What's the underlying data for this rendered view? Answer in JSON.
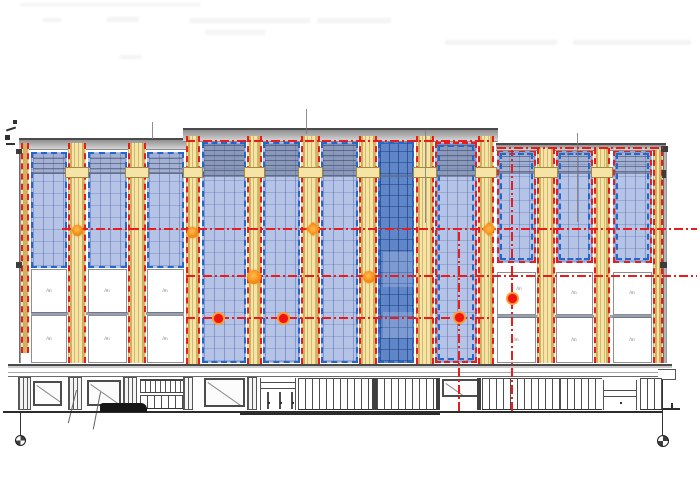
{
  "drawing": {
    "panel_mark": "/m",
    "colors": {
      "yellow": "#f5e4a6",
      "panel-blue": "#b4c3e6",
      "panel-dark": "#5e86c8",
      "red": "#e81c1c",
      "dotred": "#f01410",
      "orange": "#f58c16",
      "blue-dash": "#2268cc"
    },
    "smudges": [
      {
        "x": 20,
        "y": 3,
        "w": 180,
        "h": 3
      },
      {
        "x": 43,
        "y": 18,
        "w": 18,
        "h": 4
      },
      {
        "x": 107,
        "y": 17,
        "w": 32,
        "h": 5
      },
      {
        "x": 190,
        "y": 18,
        "w": 120,
        "h": 5
      },
      {
        "x": 317,
        "y": 18,
        "w": 74,
        "h": 5
      },
      {
        "x": 205,
        "y": 30,
        "w": 60,
        "h": 5
      },
      {
        "x": 445,
        "y": 40,
        "w": 112,
        "h": 5
      },
      {
        "x": 573,
        "y": 40,
        "w": 118,
        "h": 5
      },
      {
        "x": 120,
        "y": 55,
        "w": 22,
        "h": 4
      }
    ],
    "roof_bands": [
      {
        "x": 19,
        "y": 138,
        "w": 167,
        "h": 12
      },
      {
        "x": 183,
        "y": 128,
        "w": 315,
        "h": 14
      },
      {
        "x": 496,
        "y": 143,
        "w": 170,
        "h": 8
      }
    ],
    "leader_lines": [
      {
        "x": 152,
        "y": 122,
        "h": 17
      },
      {
        "x": 306,
        "y": 109,
        "h": 25
      },
      {
        "x": 425,
        "y": 130,
        "h": 93
      },
      {
        "x": 577,
        "y": 133,
        "h": 89
      }
    ],
    "edge_bands": [
      {
        "x": 19,
        "y": 150,
        "w": 2,
        "h": 213
      },
      {
        "x": 663,
        "y": 151,
        "w": 4,
        "h": 212
      }
    ],
    "edge_squares": [
      {
        "x": 16,
        "y": 149,
        "w": 6,
        "h": 5
      },
      {
        "x": 16,
        "y": 262,
        "w": 6,
        "h": 6
      },
      {
        "x": 661,
        "y": 146,
        "w": 7,
        "h": 6
      },
      {
        "x": 662,
        "y": 170,
        "w": 4,
        "h": 8
      },
      {
        "x": 660,
        "y": 262,
        "w": 7,
        "h": 6
      }
    ],
    "tiny_marks": [
      {
        "x": 13,
        "y": 120,
        "w": 4,
        "h": 4,
        "r": 0
      },
      {
        "x": 6,
        "y": 128,
        "w": 10,
        "h": 2,
        "r": -18
      },
      {
        "x": 5,
        "y": 135,
        "w": 5,
        "h": 5,
        "r": 0
      },
      {
        "x": 6,
        "y": 143,
        "w": 9,
        "h": 2,
        "r": 0
      }
    ],
    "yellow_strips": [
      {
        "x": 21,
        "y": 143,
        "w": 8,
        "h": 210,
        "cap": false
      },
      {
        "x": 68,
        "y": 143,
        "w": 18,
        "h": 220,
        "cap": true
      },
      {
        "x": 128,
        "y": 143,
        "w": 18,
        "h": 220,
        "cap": true
      },
      {
        "x": 186,
        "y": 136,
        "w": 14,
        "h": 228,
        "cap": true
      },
      {
        "x": 247,
        "y": 136,
        "w": 15,
        "h": 228,
        "cap": true
      },
      {
        "x": 301,
        "y": 136,
        "w": 19,
        "h": 228,
        "cap": true
      },
      {
        "x": 359,
        "y": 136,
        "w": 18,
        "h": 228,
        "cap": true
      },
      {
        "x": 416,
        "y": 136,
        "w": 18,
        "h": 228,
        "cap": true
      },
      {
        "x": 478,
        "y": 136,
        "w": 16,
        "h": 228,
        "cap": true
      },
      {
        "x": 537,
        "y": 148,
        "w": 18,
        "h": 215,
        "cap": true
      },
      {
        "x": 594,
        "y": 148,
        "w": 16,
        "h": 215,
        "cap": true
      },
      {
        "x": 653,
        "y": 150,
        "w": 10,
        "h": 213,
        "cap": false
      }
    ],
    "blue_panels": [
      {
        "x": 31,
        "y": 152,
        "w": 36,
        "h": 116,
        "band": "soft",
        "bh": 20
      },
      {
        "x": 88,
        "y": 152,
        "w": 39,
        "h": 116,
        "band": "soft",
        "bh": 20
      },
      {
        "x": 147,
        "y": 152,
        "w": 37,
        "h": 116,
        "band": "soft",
        "bh": 20
      },
      {
        "x": 202,
        "y": 142,
        "w": 44,
        "h": 221,
        "band": "strong",
        "bh": 32
      },
      {
        "x": 263,
        "y": 142,
        "w": 37,
        "h": 221,
        "band": "strong",
        "bh": 32
      },
      {
        "x": 321,
        "y": 142,
        "w": 37,
        "h": 221,
        "band": "strong",
        "bh": 32
      },
      {
        "x": 378,
        "y": 142,
        "w": 36,
        "h": 221,
        "dark": true,
        "glints": [
          {
            "x": 3,
            "y": 108,
            "w": 30,
            "h": 35
          },
          {
            "x": 3,
            "y": 168,
            "w": 30,
            "h": 26
          }
        ]
      },
      {
        "x": 435,
        "y": 142,
        "w": 42,
        "h": 221,
        "band": "strong",
        "bh": 32,
        "dual": true
      },
      {
        "x": 497,
        "y": 150,
        "w": 39,
        "h": 113,
        "band": "soft",
        "bh": 20,
        "dual": true
      },
      {
        "x": 556,
        "y": 150,
        "w": 37,
        "h": 113,
        "band": "soft",
        "bh": 20,
        "dual": true
      },
      {
        "x": 613,
        "y": 150,
        "w": 39,
        "h": 113,
        "band": "soft",
        "bh": 20,
        "dual": true
      }
    ],
    "mullions": [
      {
        "x": 31,
        "y": 172,
        "w": 153,
        "h": 2
      },
      {
        "x": 202,
        "y": 175,
        "w": 275,
        "h": 2
      },
      {
        "x": 497,
        "y": 172,
        "w": 155,
        "h": 2
      },
      {
        "x": 31,
        "y": 312,
        "w": 153,
        "h": 3
      },
      {
        "x": 497,
        "y": 315,
        "w": 155,
        "h": 3
      }
    ],
    "white_panels": [
      {
        "x": 31,
        "y": 269,
        "w": 36,
        "h": 44
      },
      {
        "x": 88,
        "y": 269,
        "w": 39,
        "h": 44
      },
      {
        "x": 147,
        "y": 269,
        "w": 37,
        "h": 44
      },
      {
        "x": 31,
        "y": 315,
        "w": 36,
        "h": 48
      },
      {
        "x": 88,
        "y": 315,
        "w": 39,
        "h": 48
      },
      {
        "x": 147,
        "y": 315,
        "w": 37,
        "h": 48
      },
      {
        "x": 497,
        "y": 272,
        "w": 39,
        "h": 43
      },
      {
        "x": 556,
        "y": 272,
        "w": 37,
        "h": 43
      },
      {
        "x": 613,
        "y": 272,
        "w": 39,
        "h": 43
      },
      {
        "x": 497,
        "y": 317,
        "w": 39,
        "h": 46
      },
      {
        "x": 556,
        "y": 317,
        "w": 37,
        "h": 46
      },
      {
        "x": 613,
        "y": 317,
        "w": 39,
        "h": 46
      }
    ],
    "marks": [
      {
        "x": 49,
        "y": 291
      },
      {
        "x": 107,
        "y": 291
      },
      {
        "x": 165,
        "y": 291
      },
      {
        "x": 49,
        "y": 339
      },
      {
        "x": 107,
        "y": 339
      },
      {
        "x": 165,
        "y": 339
      },
      {
        "x": 519,
        "y": 289
      },
      {
        "x": 574,
        "y": 293
      },
      {
        "x": 632,
        "y": 293
      },
      {
        "x": 516,
        "y": 340
      },
      {
        "x": 574,
        "y": 340
      },
      {
        "x": 632,
        "y": 340
      }
    ],
    "red_h_lines": [
      {
        "x": 62,
        "y": 228,
        "w": 635
      },
      {
        "x": 186,
        "y": 275,
        "w": 511
      },
      {
        "x": 186,
        "y": 317,
        "w": 308
      },
      {
        "x": 186,
        "y": 140,
        "w": 308
      },
      {
        "x": 497,
        "y": 147,
        "w": 166
      }
    ],
    "red_v_lines": [
      {
        "x": 458,
        "y": 231,
        "h": 180
      },
      {
        "x": 511,
        "y": 150,
        "h": 261
      }
    ],
    "dots": [
      {
        "x": 77,
        "y": 230,
        "d": 11,
        "t": "orange"
      },
      {
        "x": 192,
        "y": 232,
        "d": 11,
        "t": "orange"
      },
      {
        "x": 313,
        "y": 229,
        "d": 10,
        "t": "diamond"
      },
      {
        "x": 489,
        "y": 229,
        "d": 10,
        "t": "diamond"
      },
      {
        "x": 254,
        "y": 277,
        "d": 14,
        "t": "orange"
      },
      {
        "x": 369,
        "y": 277,
        "d": 12,
        "t": "orange"
      },
      {
        "x": 218,
        "y": 318,
        "d": 13,
        "t": "red"
      },
      {
        "x": 283,
        "y": 318,
        "d": 13,
        "t": "red"
      },
      {
        "x": 459,
        "y": 317,
        "d": 13,
        "t": "red"
      },
      {
        "x": 512,
        "y": 298,
        "d": 13,
        "t": "red"
      }
    ],
    "storefront": {
      "fascia": {
        "x": 8,
        "y": 364,
        "w": 664,
        "h": 13
      },
      "fascia_line": {
        "x": 8,
        "y": 372,
        "w": 664,
        "h": 1
      },
      "canopy": {
        "x": 658,
        "y": 369,
        "w": 18,
        "h": 11
      },
      "pilasters": [
        {
          "x": 18,
          "w": 13
        },
        {
          "x": 68,
          "w": 14
        },
        {
          "x": 123,
          "w": 14
        },
        {
          "x": 183,
          "w": 10
        },
        {
          "x": 247,
          "w": 10
        }
      ],
      "windows": [
        {
          "x": 33,
          "y": 381,
          "w": 29,
          "h": 25
        },
        {
          "x": 87,
          "y": 380,
          "w": 34,
          "h": 26
        },
        {
          "x": 204,
          "y": 378,
          "w": 41,
          "h": 29
        },
        {
          "x": 442,
          "y": 379,
          "w": 38,
          "h": 18
        }
      ],
      "railing": {
        "x": 140,
        "y": 379,
        "w": 43,
        "h": 14
      },
      "fence": {
        "x": 140,
        "y": 395,
        "w": 43,
        "h": 14
      },
      "doors": [
        {
          "x": 260,
          "y": 378,
          "w": 36,
          "h": 32,
          "lines": [
            4,
            10
          ],
          "mulls": [
            6,
            18,
            30
          ],
          "dots": [
            7,
            19,
            31
          ]
        },
        {
          "x": 603,
          "y": 380,
          "w": 34,
          "h": 30,
          "lines": [
            10,
            16
          ],
          "mulls": [],
          "dots": [
            16
          ]
        }
      ],
      "slat_areas": [
        {
          "x": 298,
          "w": 74
        },
        {
          "x": 377,
          "w": 61
        },
        {
          "x": 482,
          "w": 78
        },
        {
          "x": 560,
          "w": 42
        },
        {
          "x": 640,
          "w": 22
        }
      ],
      "posts": [
        {
          "x": 372,
          "w": 5
        },
        {
          "x": 436,
          "w": 4
        },
        {
          "x": 477,
          "w": 4
        }
      ],
      "dark_object": {
        "x": 100,
        "y": 403,
        "w": 47,
        "h": 9
      },
      "leaders": [
        {
          "x": 76,
          "y": 390,
          "len": 34,
          "ang": 14
        },
        {
          "x": 100,
          "y": 392,
          "len": 38,
          "ang": 11
        }
      ]
    },
    "ground": [
      {
        "x": 3,
        "y": 411,
        "w": 660,
        "h": 2
      },
      {
        "x": 240,
        "y": 412,
        "w": 200,
        "h": 3
      },
      {
        "x": 662,
        "y": 408,
        "w": 18,
        "h": 2
      },
      {
        "x": 671,
        "y": 403,
        "w": 2,
        "h": 7
      }
    ],
    "benchmarks": [
      {
        "stem": {
          "x": 20,
          "y": 413,
          "w": 1,
          "h": 22
        },
        "circle": {
          "x": 15,
          "y": 435,
          "d": 11
        }
      },
      {
        "stem": {
          "x": 662,
          "y": 380,
          "w": 1,
          "h": 56
        },
        "circle": {
          "x": 657,
          "y": 435,
          "d": 12
        }
      }
    ]
  }
}
